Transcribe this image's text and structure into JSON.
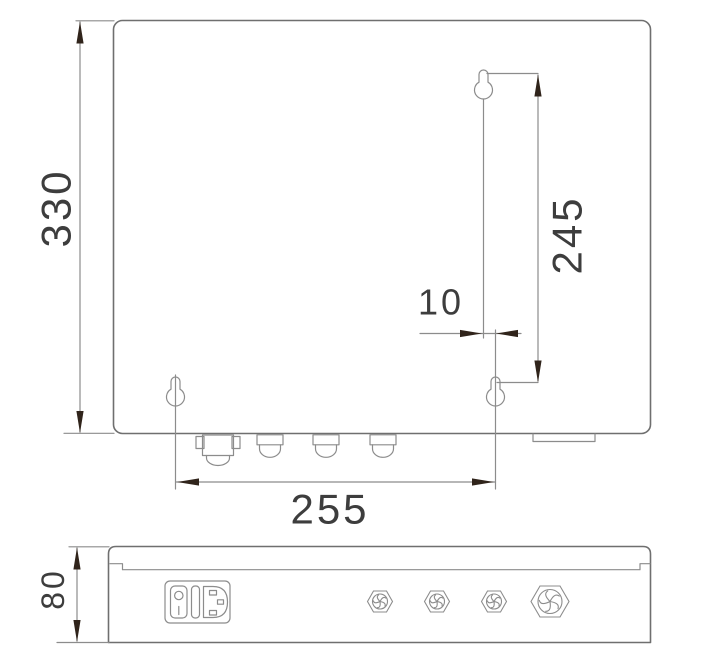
{
  "drawing": {
    "type": "technical-dimension-drawing",
    "subject": "wall-mount-enclosure",
    "views": {
      "rear_view": "enclosure rear panel with keyhole mounting slots and cable glands",
      "bottom_view": "enclosure bottom side with power inlet and cable glands"
    },
    "dimensions": {
      "overall_height": "330",
      "keyhole_vertical_spacing": "245",
      "keyhole_horizontal_offset": "10",
      "keyhole_horizontal_spacing": "255",
      "enclosure_depth": "80"
    },
    "colors": {
      "background": "#ffffff",
      "outline": "#6f6f6f",
      "thin_line": "#8c8c8c",
      "arrow": "#30241b",
      "text": "#3d3d3d"
    }
  }
}
